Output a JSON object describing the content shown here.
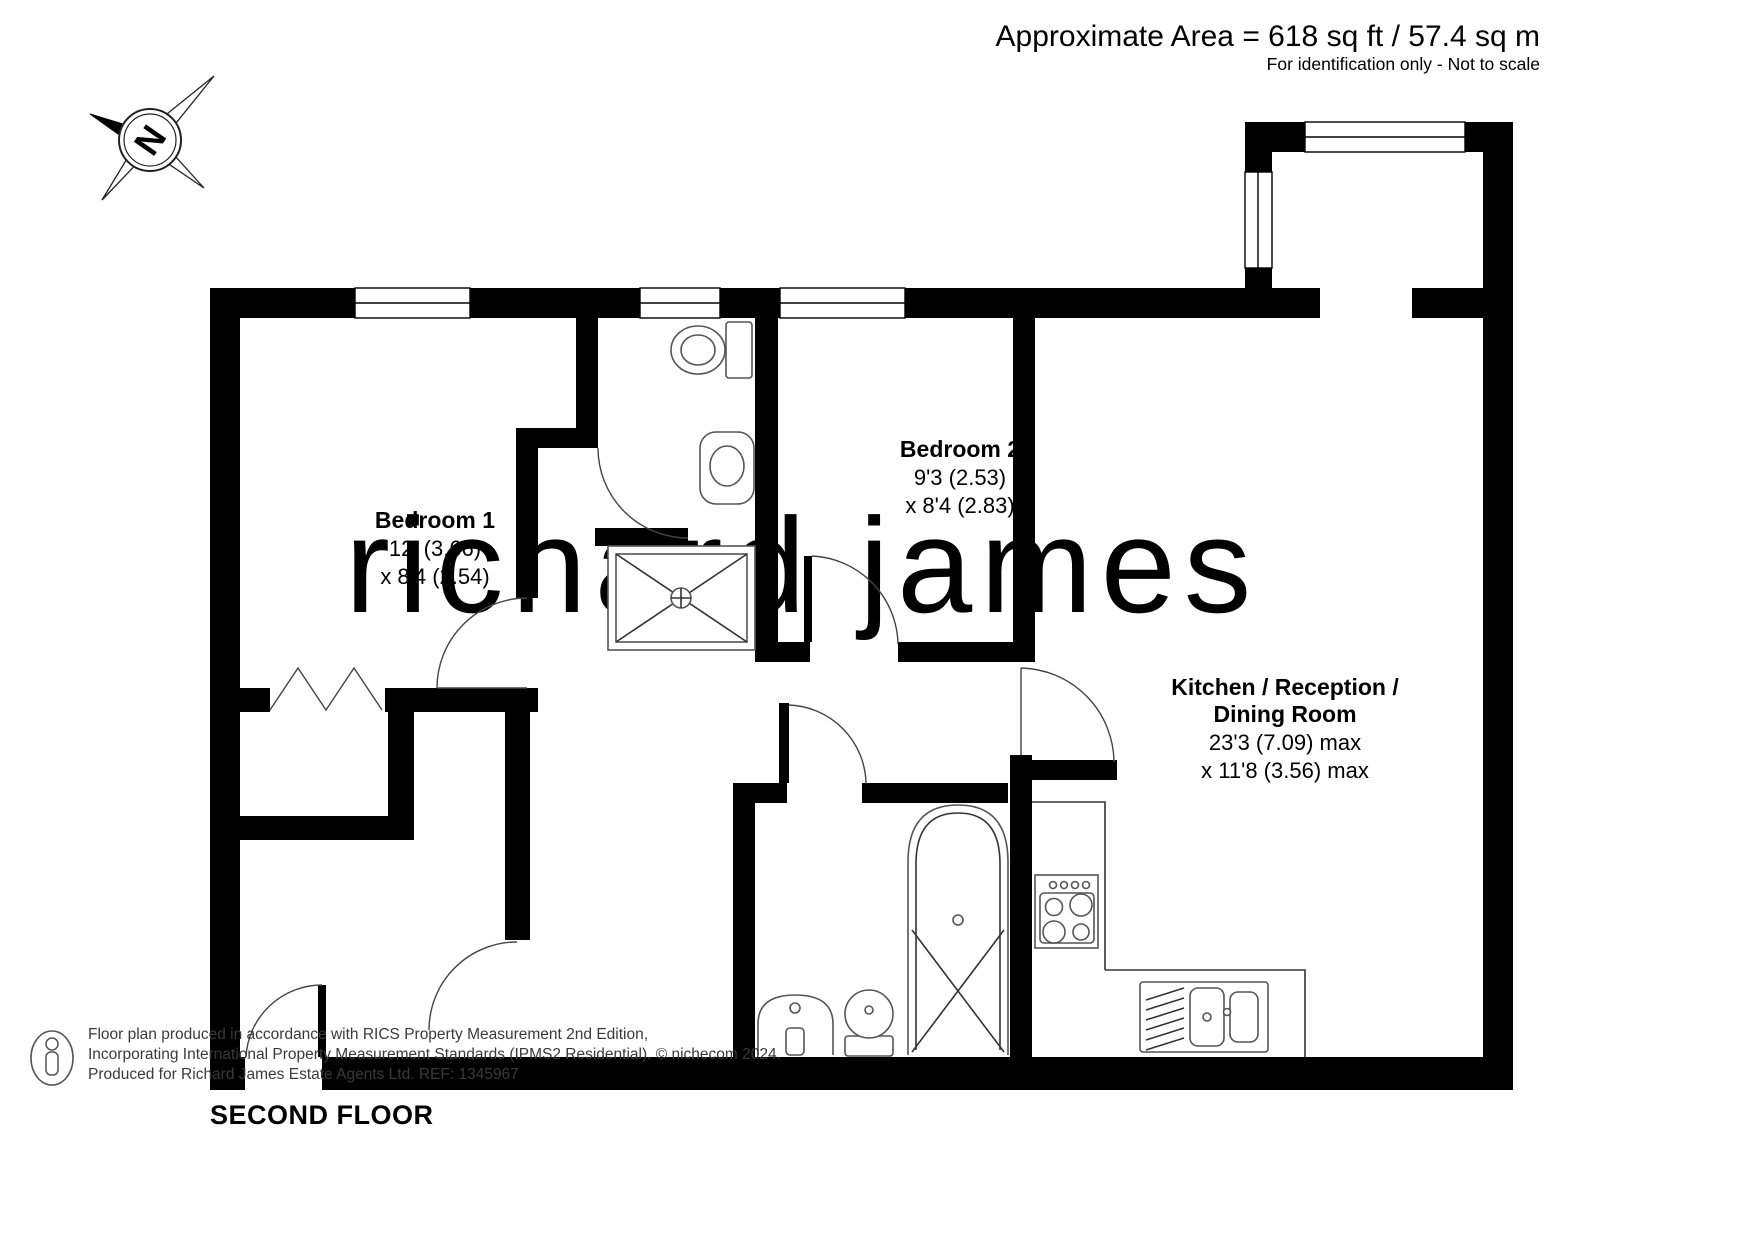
{
  "header": {
    "area_line": "Approximate Area = 618 sq ft / 57.4 sq m",
    "disclaimer": "For identification only - Not to scale"
  },
  "compass": {
    "label": "N"
  },
  "watermark": "richard james",
  "floor_label": "SECOND FLOOR",
  "rooms": [
    {
      "name": "Bedroom 1",
      "dim1": "12' (3.66)",
      "dim2": "x 8'4 (2.54)"
    },
    {
      "name": "Bedroom 2",
      "dim1": "9'3 (2.53)",
      "dim2": "x 8'4 (2.83)"
    },
    {
      "name_line1": "Kitchen / Reception /",
      "name_line2": "Dining Room",
      "dim1": "23'3 (7.09) max",
      "dim2": "x 11'8 (3.56) max"
    }
  ],
  "footer": {
    "line1": "Floor plan produced in accordance with RICS Property Measurement 2nd Edition,",
    "line2": "Incorporating International Property Measurement Standards (IPMS2 Residential).   © nichecom 2024.",
    "line3": "Produced for Richard James Estate Agents Ltd.   REF: 1345967"
  },
  "colors": {
    "wall": "#000000",
    "watermark": "#f3e3c0",
    "fixture_line": "#555555",
    "footer_text": "#3a3a3a"
  }
}
